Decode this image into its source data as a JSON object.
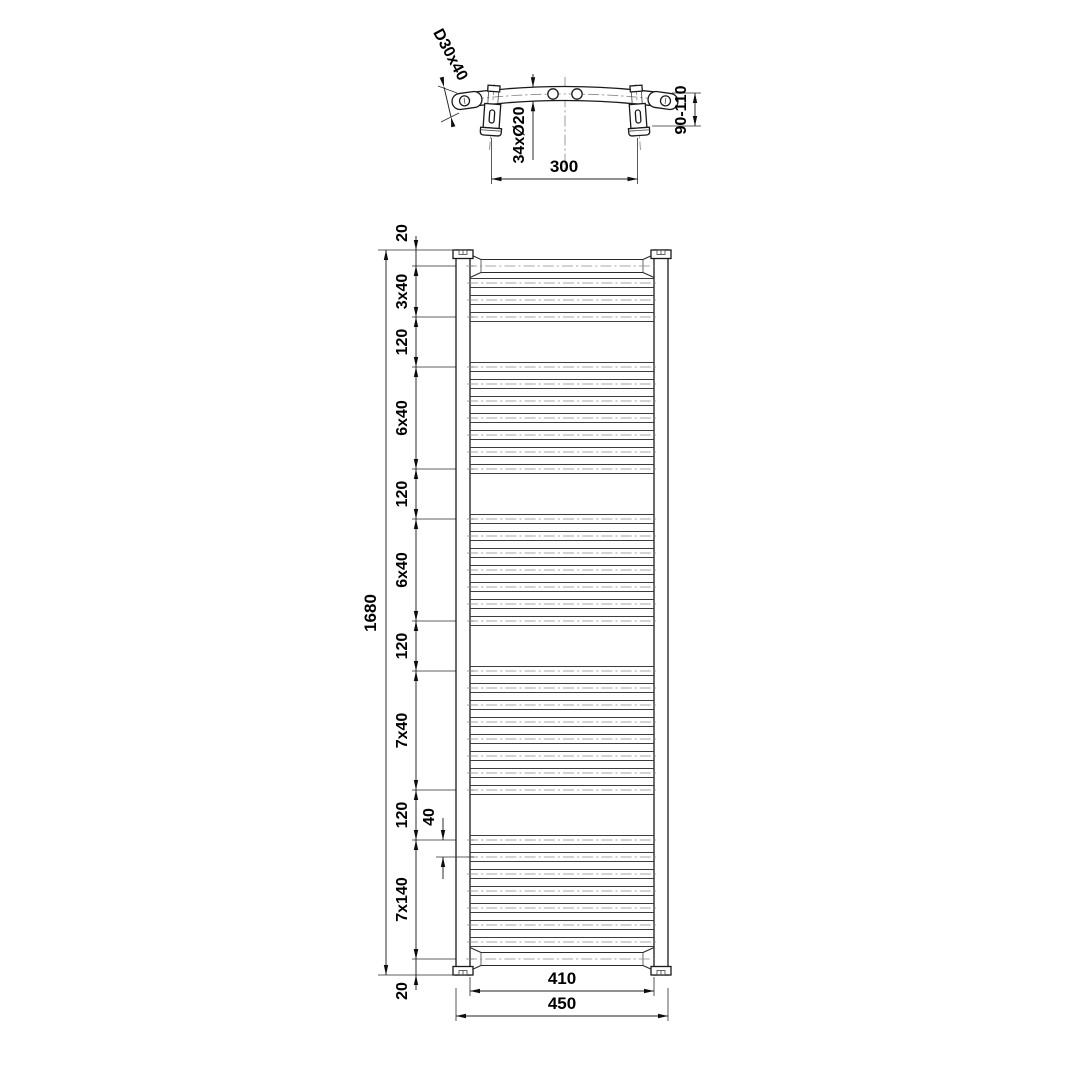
{
  "top_view": {
    "profile_label": "D30x40",
    "rung_count_label": "34xØ20",
    "wall_distance_label": "90-110",
    "bracket_spacing_label": "300"
  },
  "front_view": {
    "overall_height_label": "1680",
    "overall_width_label": "450",
    "inner_width_label": "410",
    "rung_gap_detail_label": "40",
    "chain_labels": [
      "20",
      "3x40",
      "120",
      "6x40",
      "120",
      "6x40",
      "120",
      "7x40",
      "120",
      "7x140",
      "20"
    ],
    "rung_sections": [
      {
        "label": "3x40",
        "rungs": 3,
        "start_mm": 60
      },
      {
        "label": "6x40",
        "rungs": 7,
        "start_mm": 260
      },
      {
        "label": "6x40",
        "rungs": 7,
        "start_mm": 620
      },
      {
        "label": "7x40",
        "rungs": 8,
        "start_mm": 980
      },
      {
        "label": "7x140",
        "rungs": 7,
        "start_mm": 1380
      }
    ],
    "rung_spacing_mm": 40
  }
}
